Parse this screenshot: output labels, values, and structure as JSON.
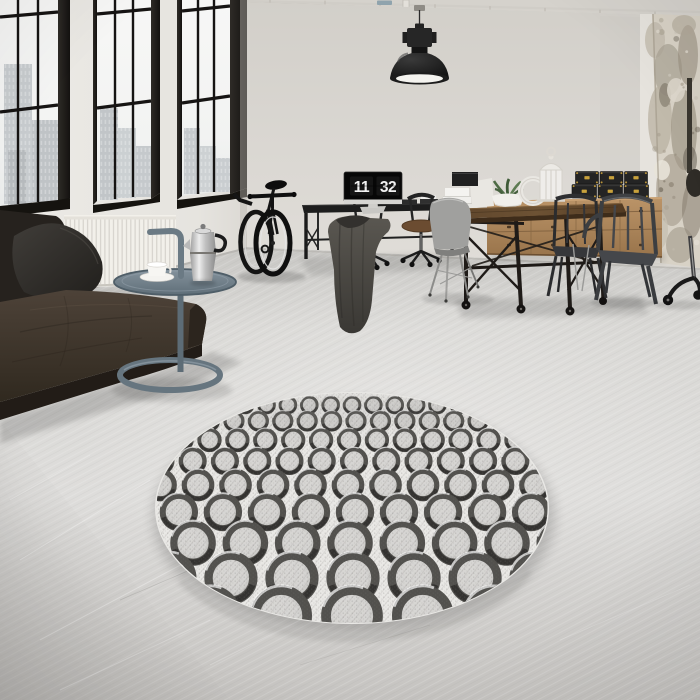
{
  "meta": {
    "scene": "loft interior photo: round patterned rug, leather sofa, industrial windows, desk with flip-clock monitor, wooden dining table with metal chairs",
    "style": "render / product photo, desaturated grey tones"
  },
  "clock": {
    "hours": "11",
    "minutes": "32",
    "display": "11 32"
  },
  "palette": {
    "ceiling": "#d5d2cc",
    "wall_back": "#d9d6d1",
    "wall_left": "#e9e7e3",
    "frame_dark": "#1b1917",
    "glass": "#f4f4f2",
    "floor": "#d8d7d4",
    "radiator": "#f2f0ea",
    "sofa": "#3c332b",
    "side_table": "#6f7e8a",
    "bike": "#141414",
    "desk": "#1d1d1d",
    "seat_brown": "#6b4c31",
    "monitor_screen": "#070707",
    "clock_text": "#f2f2f2",
    "monitor_chin": "#d6d5d2",
    "coat": "#4a4843",
    "shell_chair": "#a0a09e",
    "table_wood": "#573e26",
    "iron": "#1f1b18",
    "sideboard_wood": "#b08a5c",
    "box": "#242424",
    "box_hardware": "#c9a23c",
    "lantern": "#efedea",
    "plant": "#4d6b44",
    "metal_chair": "#3f4144",
    "pillar": "#d8d2c6",
    "rug_bg": "#e9e8e5",
    "rug_ring": "#4b4a47",
    "rug_ring_dark": "#2e2d2b",
    "rug_inner": "#d6d5d2",
    "lamp": "#1c1c1c",
    "lamp_inner": "#f4f3ef"
  },
  "windows": {
    "mullion_color": "#161413",
    "units": [
      {
        "id": "w1",
        "glass": [
          [
            0,
            0
          ],
          [
            58,
            0
          ],
          [
            58,
            200
          ],
          [
            0,
            206
          ]
        ],
        "frames": [
          [
            [
              58,
              0
            ],
            [
              70,
              0
            ],
            [
              70,
              198
            ],
            [
              58,
              204
            ]
          ]
        ],
        "sill": [
          [
            0,
            206
          ],
          [
            58,
            200
          ],
          [
            70,
            198
          ],
          [
            70,
            209
          ],
          [
            0,
            217
          ]
        ],
        "verticals": [
          [
            18,
            0,
            18,
            204
          ],
          [
            38,
            0,
            38,
            202
          ]
        ],
        "horizontals": [
          [
            0,
            17,
            58,
            12
          ],
          [
            0,
            112,
            58,
            105
          ]
        ],
        "buildings": [
          {
            "x": 4,
            "y": 64,
            "w": 28,
            "h": 140,
            "c": "#c7cbce"
          },
          {
            "x": 32,
            "y": 120,
            "w": 26,
            "h": 82,
            "c": "#bfc3c6"
          },
          {
            "x": 8,
            "y": 150,
            "w": 18,
            "h": 55,
            "c": "#b6babd"
          }
        ]
      },
      {
        "id": "w2",
        "glass": [
          [
            97,
            0
          ],
          [
            151,
            0
          ],
          [
            151,
            195
          ],
          [
            97,
            201
          ]
        ],
        "frames": [
          [
            [
              93,
              0
            ],
            [
              97,
              0
            ],
            [
              97,
              201
            ],
            [
              93,
              205
            ]
          ],
          [
            [
              151,
              0
            ],
            [
              160,
              0
            ],
            [
              160,
              193
            ],
            [
              151,
              199
            ]
          ]
        ],
        "sill": [
          [
            93,
            205
          ],
          [
            151,
            199
          ],
          [
            160,
            193
          ],
          [
            160,
            202
          ],
          [
            93,
            213
          ]
        ],
        "verticals": [
          [
            115,
            0,
            115,
            199
          ],
          [
            133,
            0,
            133,
            197
          ]
        ],
        "horizontals": [
          [
            97,
            14,
            151,
            9
          ],
          [
            97,
            108,
            151,
            101
          ]
        ],
        "buildings": [
          {
            "x": 100,
            "y": 108,
            "w": 18,
            "h": 92,
            "c": "#c1c5c8"
          },
          {
            "x": 118,
            "y": 128,
            "w": 18,
            "h": 70,
            "c": "#cbd0d2"
          },
          {
            "x": 136,
            "y": 146,
            "w": 15,
            "h": 51,
            "c": "#c5c9cc"
          }
        ]
      },
      {
        "id": "w3",
        "glass": [
          [
            182,
            0
          ],
          [
            230,
            0
          ],
          [
            230,
            190
          ],
          [
            182,
            196
          ]
        ],
        "frames": [
          [
            [
              177,
              0
            ],
            [
              182,
              0
            ],
            [
              182,
              196
            ],
            [
              177,
              200
            ]
          ],
          [
            [
              230,
              0
            ],
            [
              247,
              0
            ],
            [
              247,
              188
            ],
            [
              230,
              194
            ]
          ]
        ],
        "sill": [
          [
            177,
            200
          ],
          [
            230,
            194
          ],
          [
            247,
            188
          ],
          [
            247,
            197
          ],
          [
            177,
            209
          ]
        ],
        "verticals": [
          [
            198,
            0,
            198,
            194
          ],
          [
            214,
            0,
            214,
            192
          ]
        ],
        "horizontals": [
          [
            182,
            11,
            230,
            6
          ],
          [
            182,
            103,
            230,
            96
          ]
        ],
        "buildings": [
          {
            "x": 184,
            "y": 128,
            "w": 16,
            "h": 66,
            "c": "#c6cacd"
          },
          {
            "x": 200,
            "y": 146,
            "w": 16,
            "h": 46,
            "c": "#cdd1d3"
          },
          {
            "x": 216,
            "y": 158,
            "w": 14,
            "h": 34,
            "c": "#c9cdd0"
          }
        ]
      }
    ]
  },
  "radiator": {
    "x1": 64,
    "x2": 176,
    "top": 215,
    "bottom": 284,
    "fins": 26
  },
  "ceiling_pipes": {
    "hanger_start": 270,
    "hanger_end": 690,
    "hanger_step": 55
  },
  "rug": {
    "cx": 352,
    "cy": 508,
    "rx": 197,
    "ry": 116,
    "spacing": 2.18,
    "rows": [
      {
        "cy": 405,
        "r": 9.8,
        "j": 0
      },
      {
        "cy": 421,
        "r": 11.2,
        "j": 4
      },
      {
        "cy": 440,
        "r": 12.8,
        "j": -3
      },
      {
        "cy": 461,
        "r": 14.8,
        "j": 2
      },
      {
        "cy": 485,
        "r": 17.2,
        "j": -4
      },
      {
        "cy": 512,
        "r": 20.2,
        "j": 3
      },
      {
        "cy": 543,
        "r": 24,
        "j": -2
      },
      {
        "cy": 578,
        "r": 28,
        "j": 1
      },
      {
        "cy": 616,
        "r": 32.5,
        "j": 0
      }
    ]
  },
  "sideboard": {
    "handle_rows": [
      211,
      227,
      245
    ],
    "handle_cols": [
      509,
      553,
      598,
      641
    ],
    "box_rows": [
      {
        "x": 575.5,
        "y": 171.5,
        "w": 23,
        "h": 12.5,
        "cols": 3,
        "gap": 1.5
      },
      {
        "x": 572,
        "y": 184.5,
        "w": 24.5,
        "h": 13.5,
        "cols": 3,
        "gap": 1.5
      }
    ]
  },
  "pillar": {
    "seed": 7,
    "speckle_count": 30,
    "speckle_colors": [
      "#a79e8f",
      "#8c8374",
      "#c3bcae",
      "#6f675a",
      "#e8e3d8",
      "#978e7f"
    ]
  }
}
